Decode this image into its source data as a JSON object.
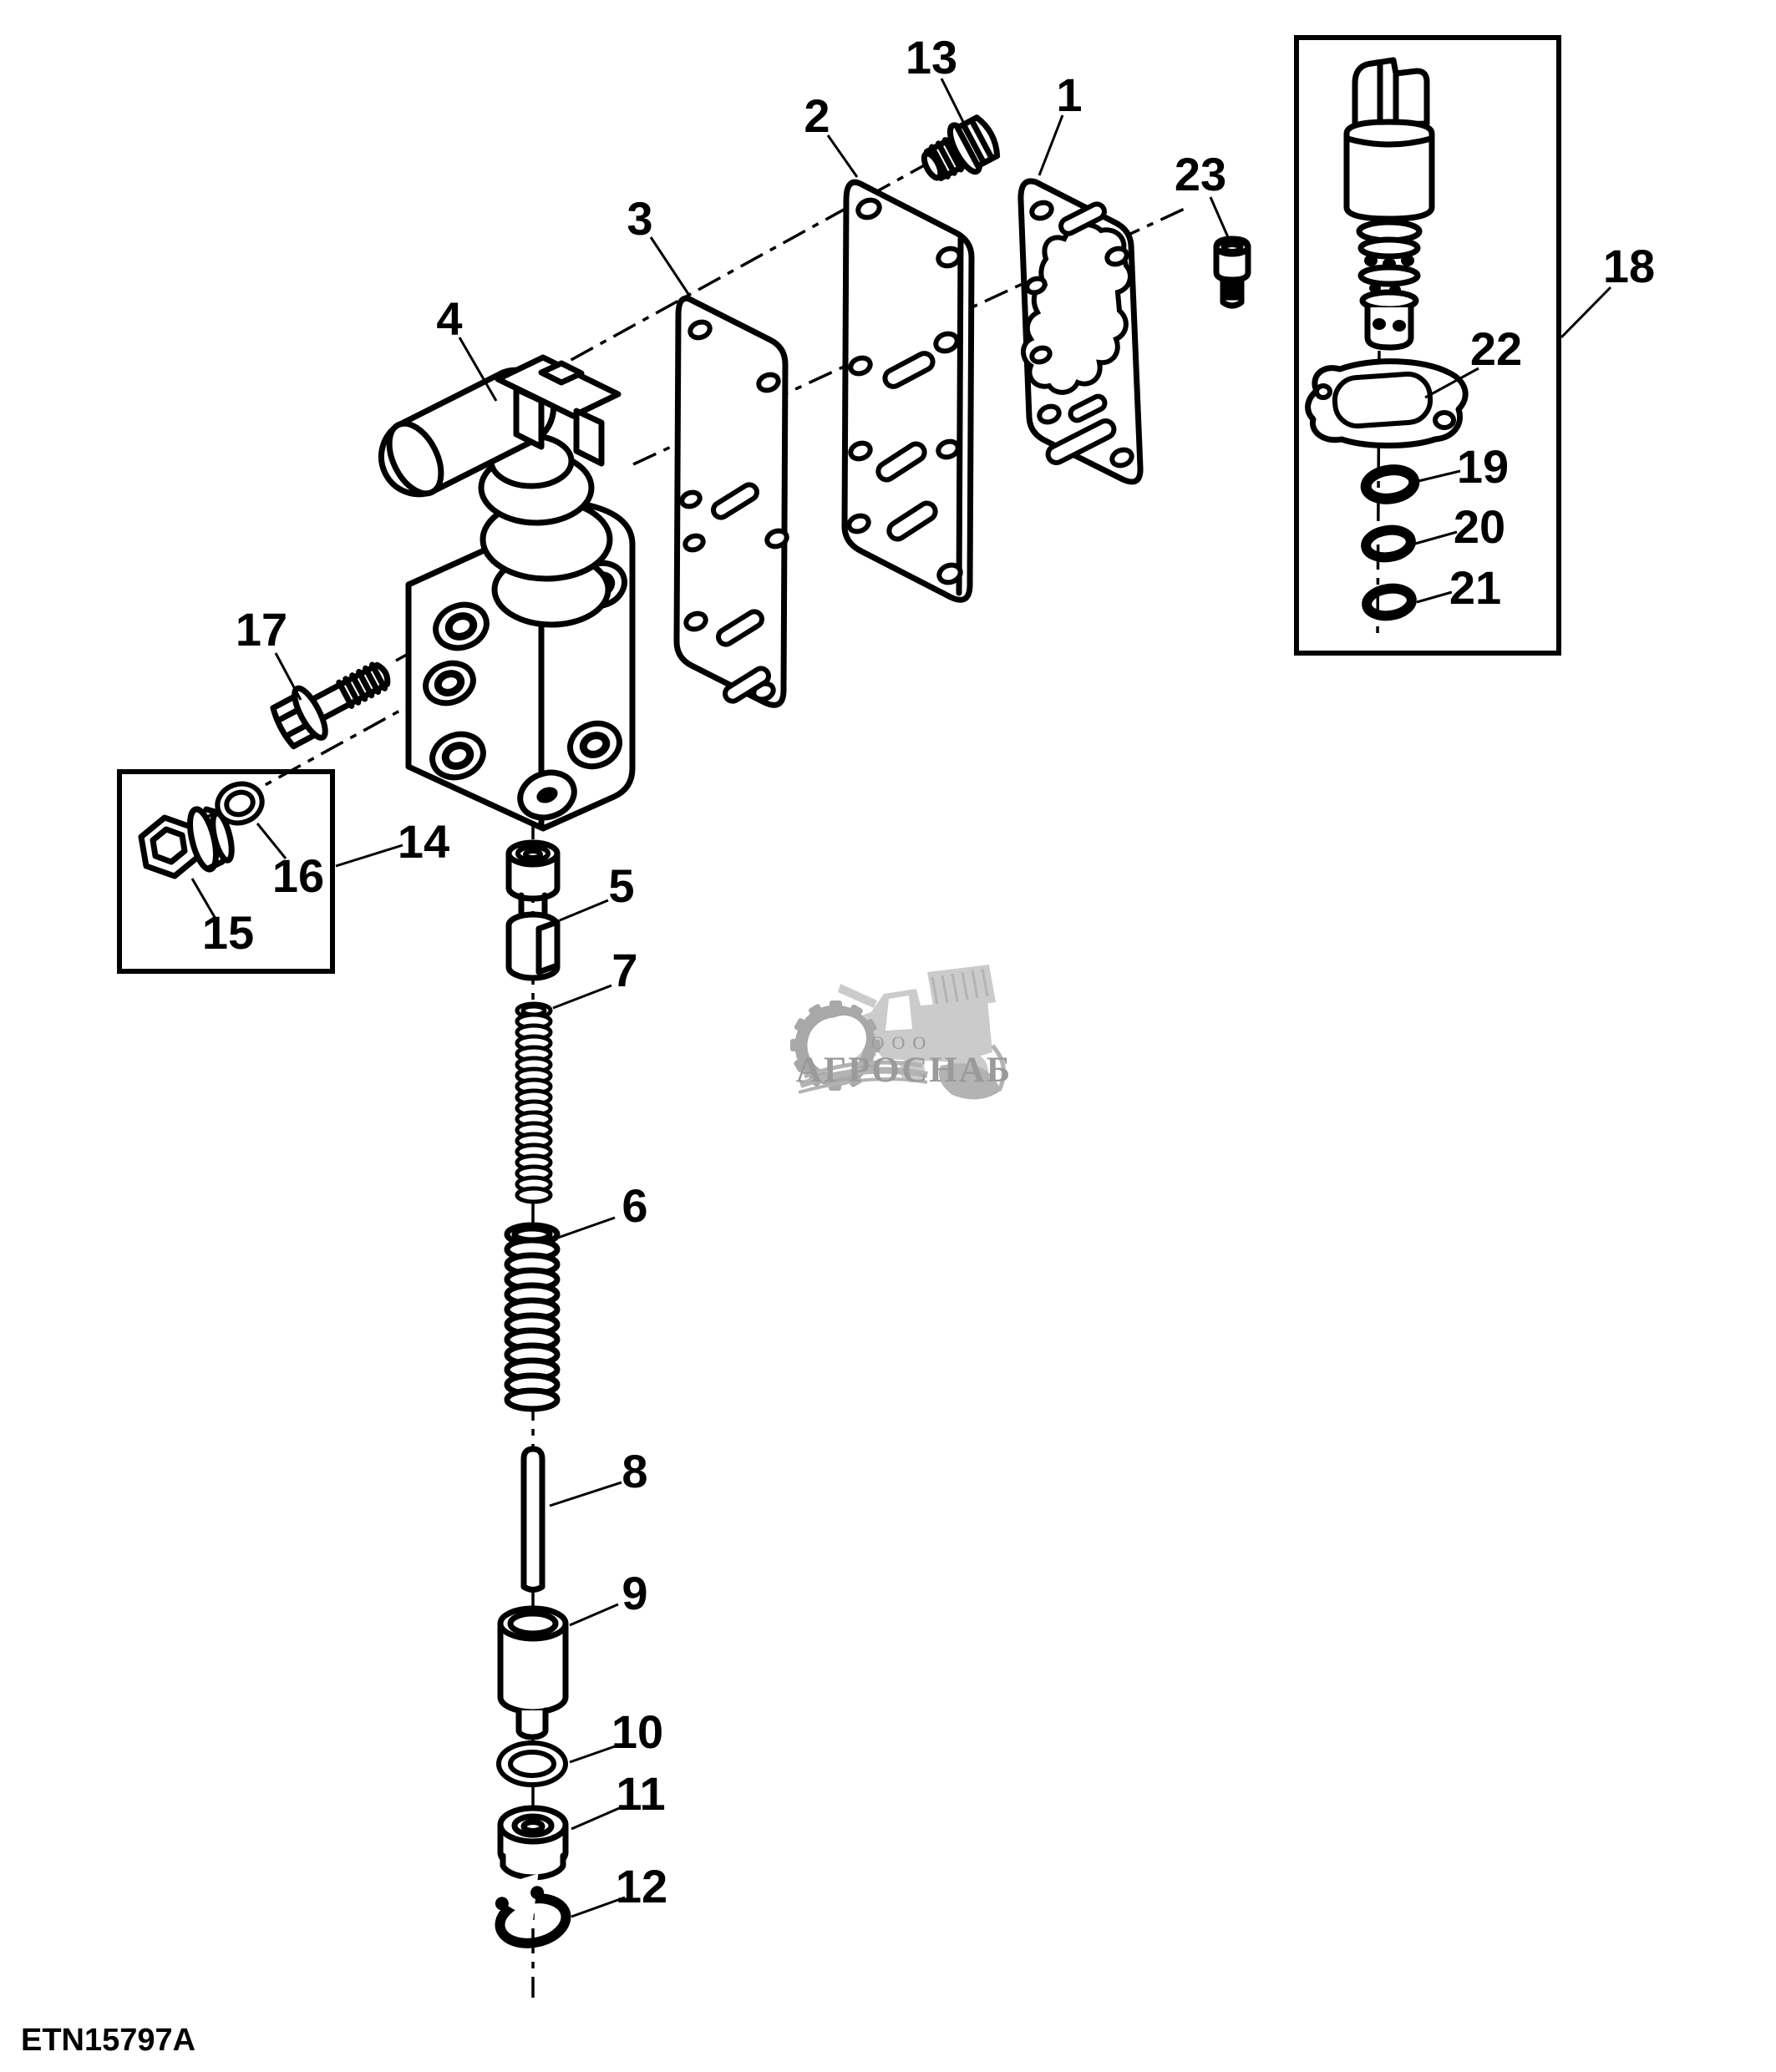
{
  "document": {
    "code": "ETN15797A"
  },
  "diagram": {
    "type": "exploded-parts-diagram",
    "callouts": [
      {
        "id": 1,
        "label": "1"
      },
      {
        "id": 2,
        "label": "2"
      },
      {
        "id": 3,
        "label": "3"
      },
      {
        "id": 4,
        "label": "4"
      },
      {
        "id": 5,
        "label": "5"
      },
      {
        "id": 6,
        "label": "6"
      },
      {
        "id": 7,
        "label": "7"
      },
      {
        "id": 8,
        "label": "8"
      },
      {
        "id": 9,
        "label": "9"
      },
      {
        "id": 10,
        "label": "10"
      },
      {
        "id": 11,
        "label": "11"
      },
      {
        "id": 12,
        "label": "12"
      },
      {
        "id": 13,
        "label": "13"
      },
      {
        "id": 14,
        "label": "14"
      },
      {
        "id": 15,
        "label": "15"
      },
      {
        "id": 16,
        "label": "16"
      },
      {
        "id": 17,
        "label": "17"
      },
      {
        "id": 18,
        "label": "18"
      },
      {
        "id": 19,
        "label": "19"
      },
      {
        "id": 20,
        "label": "20"
      },
      {
        "id": 21,
        "label": "21"
      },
      {
        "id": 22,
        "label": "22"
      },
      {
        "id": 23,
        "label": "23"
      }
    ]
  },
  "watermark": {
    "org_form": "ООО",
    "company": "АГРОСНАБ",
    "icons": [
      "gear-icon",
      "combine-harvester-icon"
    ]
  },
  "colors": {
    "line": "#000000",
    "background": "#ffffff",
    "watermark_light": "#cbcbcb",
    "watermark_mid": "#b3b3b3",
    "watermark_text": "#9a9a9a"
  }
}
